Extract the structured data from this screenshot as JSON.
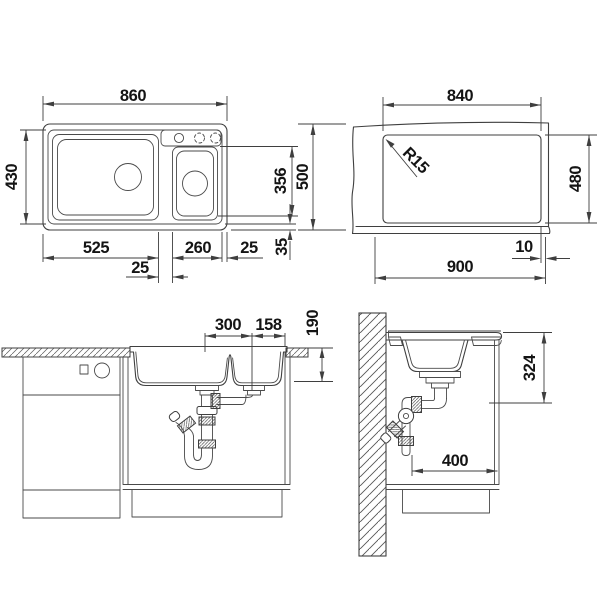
{
  "colors": {
    "background": "#ffffff",
    "line": "#3f3f3f",
    "text": "#141414"
  },
  "views": {
    "top": {
      "label": "sink-top-view",
      "dims": {
        "overall_width": "860",
        "bowl_outer_depth": "430",
        "bowl_inner_depth": "356",
        "overall_depth": "500",
        "main_bowl_width": "525",
        "half_bowl_width": "260",
        "edge_gap": "25",
        "divider_width": "25",
        "front_gap": "35"
      }
    },
    "cutout": {
      "label": "worktop-cutout-view",
      "dims": {
        "cutout_width": "840",
        "corner_radius": "R15",
        "cutout_depth": "480",
        "edge_offset": "10",
        "min_cabinet_width": "900"
      }
    },
    "front": {
      "label": "front-section-view",
      "dims": {
        "drain_spacing": "300",
        "drain_to_edge": "158",
        "bowl_depth": "190"
      }
    },
    "side": {
      "label": "side-section-view",
      "dims": {
        "clearance_height": "324",
        "clearance_depth": "400"
      }
    }
  }
}
